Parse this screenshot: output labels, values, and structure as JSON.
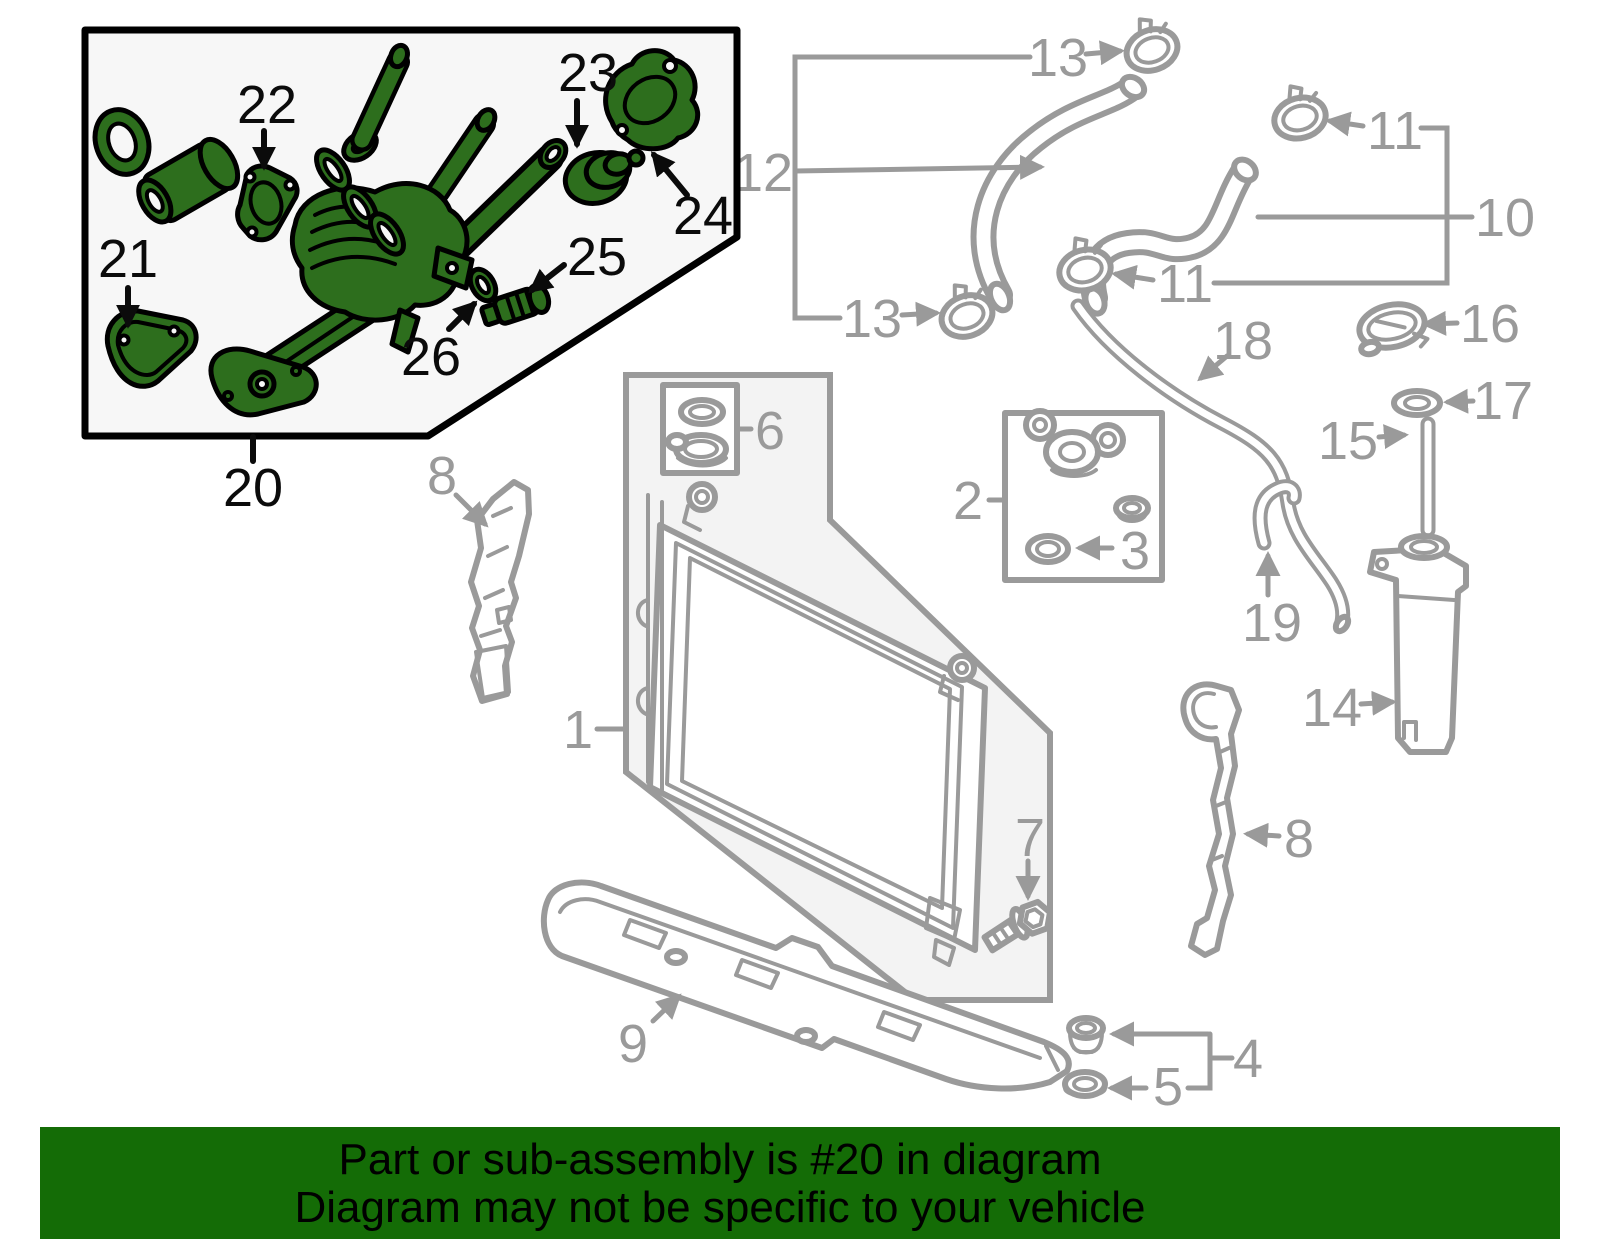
{
  "banner": {
    "line1": "Part or sub-assembly is #20 in diagram",
    "line2": "Diagram may not be specific to your vehicle",
    "bg_color": "#146c06"
  },
  "highlighted_part": {
    "number": "20"
  },
  "colors": {
    "highlight_green": "#2d6e1d",
    "diagram_gray": "#9a9a9a",
    "box_bg": "#f7f7f7",
    "shade_bg": "#f3f3f3",
    "banner_green": "#146c06"
  },
  "labels": {
    "1": "1",
    "2": "2",
    "3": "3",
    "4": "4",
    "5": "5",
    "6": "6",
    "7": "7",
    "8_left": "8",
    "8_right": "8",
    "9": "9",
    "10": "10",
    "11_top": "11",
    "11_bottom": "11",
    "12": "12",
    "13_top": "13",
    "13_bottom": "13",
    "14": "14",
    "15": "15",
    "16": "16",
    "17": "17",
    "18": "18",
    "19": "19",
    "20": "20",
    "21": "21",
    "22": "22",
    "23": "23",
    "24": "24",
    "25": "25",
    "26": "26"
  }
}
